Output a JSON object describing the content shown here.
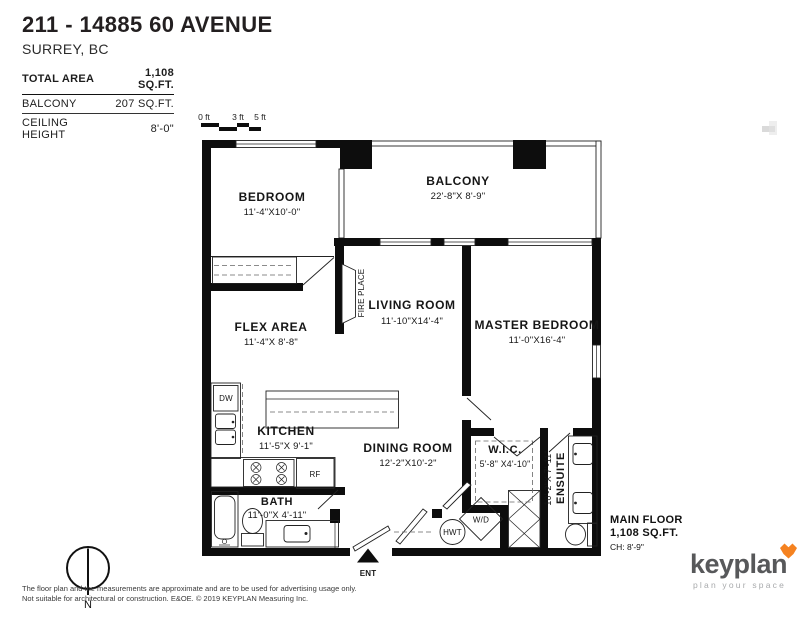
{
  "header": {
    "title": "211 - 14885 60 AVENUE",
    "subtitle": "SURREY, BC",
    "stats": [
      {
        "label": "TOTAL AREA",
        "value": "1,108 SQ.FT."
      },
      {
        "label": "BALCONY",
        "value": "207 SQ.FT."
      },
      {
        "label": "CEILING HEIGHT",
        "value": "8'-0\""
      }
    ]
  },
  "scale_bar": {
    "labels": [
      "0 ft",
      "3 ft",
      "5 ft"
    ]
  },
  "rooms": {
    "bedroom": {
      "name": "BEDROOM",
      "dims": "11'-4\"X10'-0\""
    },
    "balcony": {
      "name": "BALCONY",
      "dims": "22'-8\"X 8'-9\""
    },
    "living": {
      "name": "LIVING ROOM",
      "dims": "11'-10\"X14'-4\""
    },
    "master": {
      "name": "MASTER BEDROOM",
      "dims": "11'-0\"X16'-4\""
    },
    "flex": {
      "name": "FLEX AREA",
      "dims": "11'-4\"X 8'-8\""
    },
    "kitchen": {
      "name": "KITCHEN",
      "dims": "11'-5\"X 9'-1\""
    },
    "dining": {
      "name": "DINING ROOM",
      "dims": "12'-2\"X10'-2\""
    },
    "wic": {
      "name": "W.I.C.",
      "dims": "5'-8\" X4'-10\""
    },
    "ensuite": {
      "name": "ENSUITE",
      "dims": "10'-2\"X 7'-11\""
    },
    "bath": {
      "name": "BATH",
      "dims": "11'-0\"X 4'-11\""
    }
  },
  "fixtures": {
    "fireplace": "FIRE PLACE",
    "dishwasher": "DW",
    "fridge": "RF",
    "washer_dryer": "W/D",
    "hot_water_tank": "HWT",
    "entrance": "ENT"
  },
  "floor_info": {
    "name": "MAIN FLOOR",
    "area": "1,108 SQ.FT.",
    "ceiling": "CH: 8'-9\""
  },
  "compass": {
    "north_label": "N"
  },
  "disclaimer": {
    "line1": "The floor plan and the measurements are approximate and are to be used for advertising usage only.",
    "line2": "Not suitable for architectural or construction. E&OE. © 2019 KEYPLAN Measuring Inc."
  },
  "brand": {
    "logo_text": "keyplan",
    "tagline": "plan your space",
    "accent_color": "#f58220",
    "logo_color": "#57585a",
    "tagline_color": "#a8aaac"
  }
}
